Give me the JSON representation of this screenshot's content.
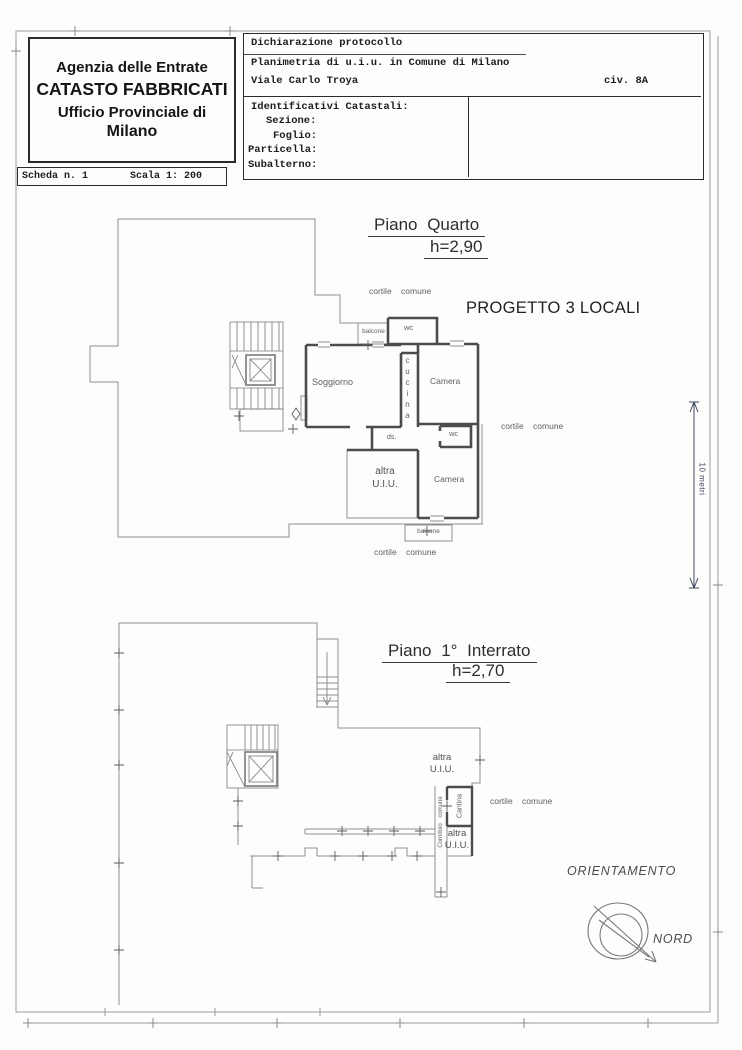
{
  "header_left": {
    "line1": "Agenzia delle Entrate",
    "line2": "CATASTO FABBRICATI",
    "line3": "Ufficio Provinciale di",
    "line4": "Milano"
  },
  "scheda_bar": {
    "scheda": "Scheda n. 1",
    "scala": "Scala 1: 200"
  },
  "header_right": {
    "line1": "Dichiarazione protocollo",
    "line2": "Planimetria di u.i.u. in Comune di Milano",
    "line3": "Viale Carlo Troya",
    "civ": "civ. 8A",
    "identificativi_title": "Identificativi Catastali:",
    "fields": [
      "Sezione:",
      "Foglio:",
      "Particella:",
      "Subalterno:"
    ]
  },
  "plan_upper": {
    "title": "Piano Quarto",
    "height": "h=2,90",
    "project": "PROGETTO 3 LOCALI",
    "labels": {
      "cortile_top": "cortile comune",
      "balcone_top": "balcone",
      "wc_top": "wc",
      "soggiorno": "Soggiorno",
      "cucina": "cucina",
      "camera_top": "Camera",
      "cortile_right": "cortile comune",
      "wc_mid": "wc",
      "ds": "ds.",
      "altra_line1": "altra",
      "altra_line2": "U.I.U.",
      "camera_bottom": "Camera",
      "balcone_bottom": "balcone",
      "cortile_bottom": "cortile comune"
    }
  },
  "plan_lower": {
    "title": "Piano 1° Interrato",
    "height": "h=2,70",
    "labels": {
      "altra_top1": "altra",
      "altra_top2": "U.I.U.",
      "cantina": "Cantina",
      "corridoio": "Corridoio comune",
      "cortile": "cortile comune",
      "altra_bottom1": "altra",
      "altra_bottom2": "U.I.U."
    }
  },
  "orientation": {
    "title": "ORIENTAMENTO",
    "north": "NORD"
  },
  "dimension": {
    "label": "10 metri"
  }
}
